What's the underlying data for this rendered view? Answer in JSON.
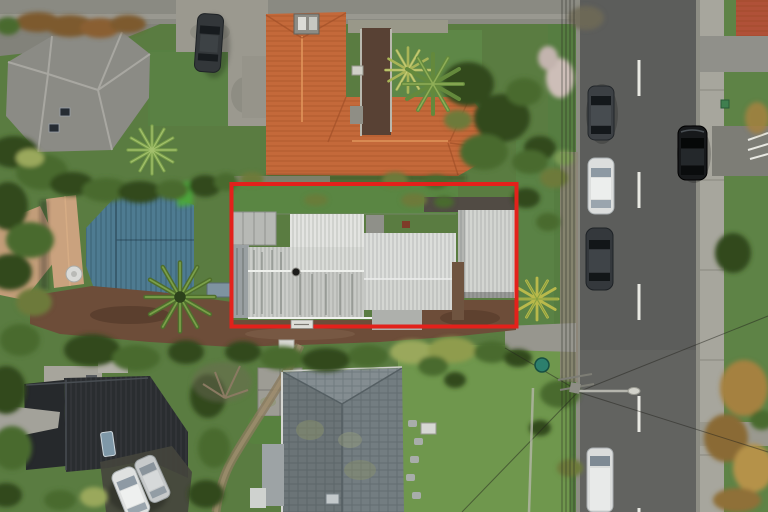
{
  "scene": {
    "type": "aerial-drone-photograph",
    "subject": "residential property marked with red boundary outline",
    "setting": "suburban street with houses, gardens and parked cars"
  },
  "boundary": {
    "color": "#e3211b",
    "shape": "rectangle",
    "plate_label": ""
  },
  "palette": {
    "grass": "#5a7c41",
    "lawn_bright": "#6f974d",
    "road": "#5c5d5b",
    "road_marking": "#e9e9e3",
    "footpath": "#a7a69d",
    "concrete": "#9b998f",
    "dirt": "#6d4d39",
    "gravel": "#514b44",
    "roof_orange": "#c4693a",
    "roof_white": "#dcdedb",
    "roof_garage": "#d3d5d1",
    "roof_blue": "#4e7b91",
    "roof_tan": "#c29d79",
    "roof_gray": "#8b8b85",
    "roof_slate": "#737d81",
    "roof_black": "#26292c",
    "roof_red_neighbor": "#b05138",
    "car_dark": "#33373a",
    "car_white": "#dcdedd",
    "car_black": "#17191b"
  },
  "objects": {
    "marked_property": {
      "roof": "white corrugated iron",
      "features": [
        "front lawn",
        "garage",
        "brown driveway",
        "carport"
      ]
    },
    "cars": [
      {
        "color": "dark grey",
        "location": "top driveway"
      },
      {
        "color": "dark grey",
        "location": "road west side upper"
      },
      {
        "color": "white",
        "location": "road west side middle"
      },
      {
        "color": "dark grey",
        "location": "road west side lower"
      },
      {
        "color": "black",
        "location": "road east side"
      },
      {
        "color": "white",
        "location": "road west side bottom"
      },
      {
        "color": "white",
        "location": "bottom-left driveway"
      },
      {
        "color": "silver",
        "location": "bottom-left driveway"
      }
    ],
    "road": {
      "orientation": "vertical",
      "marking": "white dashed centerline",
      "features": [
        "footpath",
        "grass berm",
        "power pole with streetlight",
        "overhead wires"
      ]
    }
  }
}
